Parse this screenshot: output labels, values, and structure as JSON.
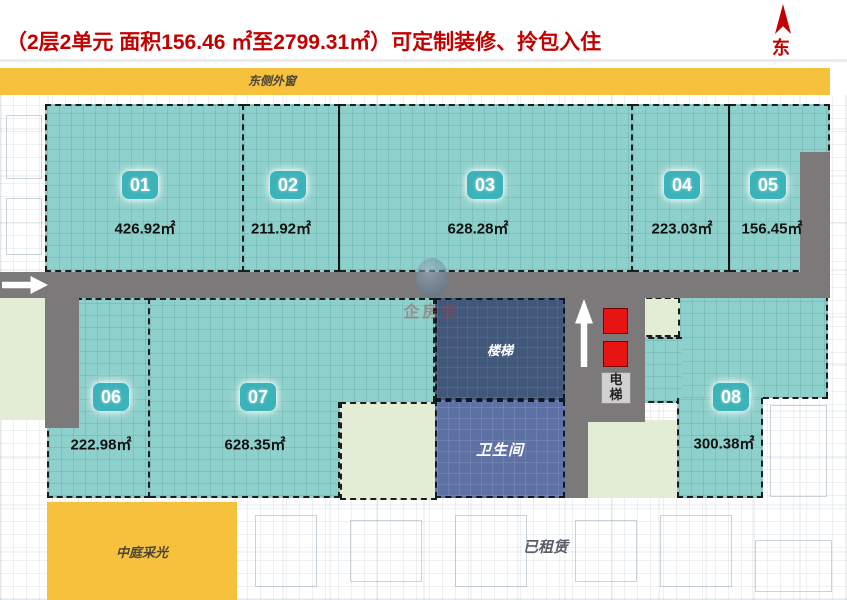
{
  "title": "（2层2单元 面积156.46 ㎡至2799.31㎡）可定制装修、拎包入住",
  "compass": {
    "label": "东"
  },
  "banner": {
    "label": "东侧外窗"
  },
  "units": [
    {
      "id": "01",
      "area": "426.92㎡"
    },
    {
      "id": "02",
      "area": "211.92㎡"
    },
    {
      "id": "03",
      "area": "628.28㎡"
    },
    {
      "id": "04",
      "area": "223.03㎡"
    },
    {
      "id": "05",
      "area": "156.45㎡"
    },
    {
      "id": "06",
      "area": "222.98㎡"
    },
    {
      "id": "07",
      "area": "628.35㎡"
    },
    {
      "id": "08",
      "area": "300.38㎡"
    }
  ],
  "facilities": {
    "stairs": "楼梯",
    "toilet": "卫生间",
    "elevator": "电梯"
  },
  "zones": {
    "atrium": "中庭采光",
    "leased": "已租赁"
  },
  "watermark": {
    "text": "企房房"
  },
  "colors": {
    "accent_red": "#c20000",
    "unit_teal": "#8ed0cb",
    "banner_yellow": "#f6c23e",
    "corridor_gray": "#7b7979",
    "stairs_navy": "#41587b",
    "toilet_blue": "#5d71a4",
    "pale_green": "#e3edd6",
    "elevator_red": "#e81414"
  }
}
